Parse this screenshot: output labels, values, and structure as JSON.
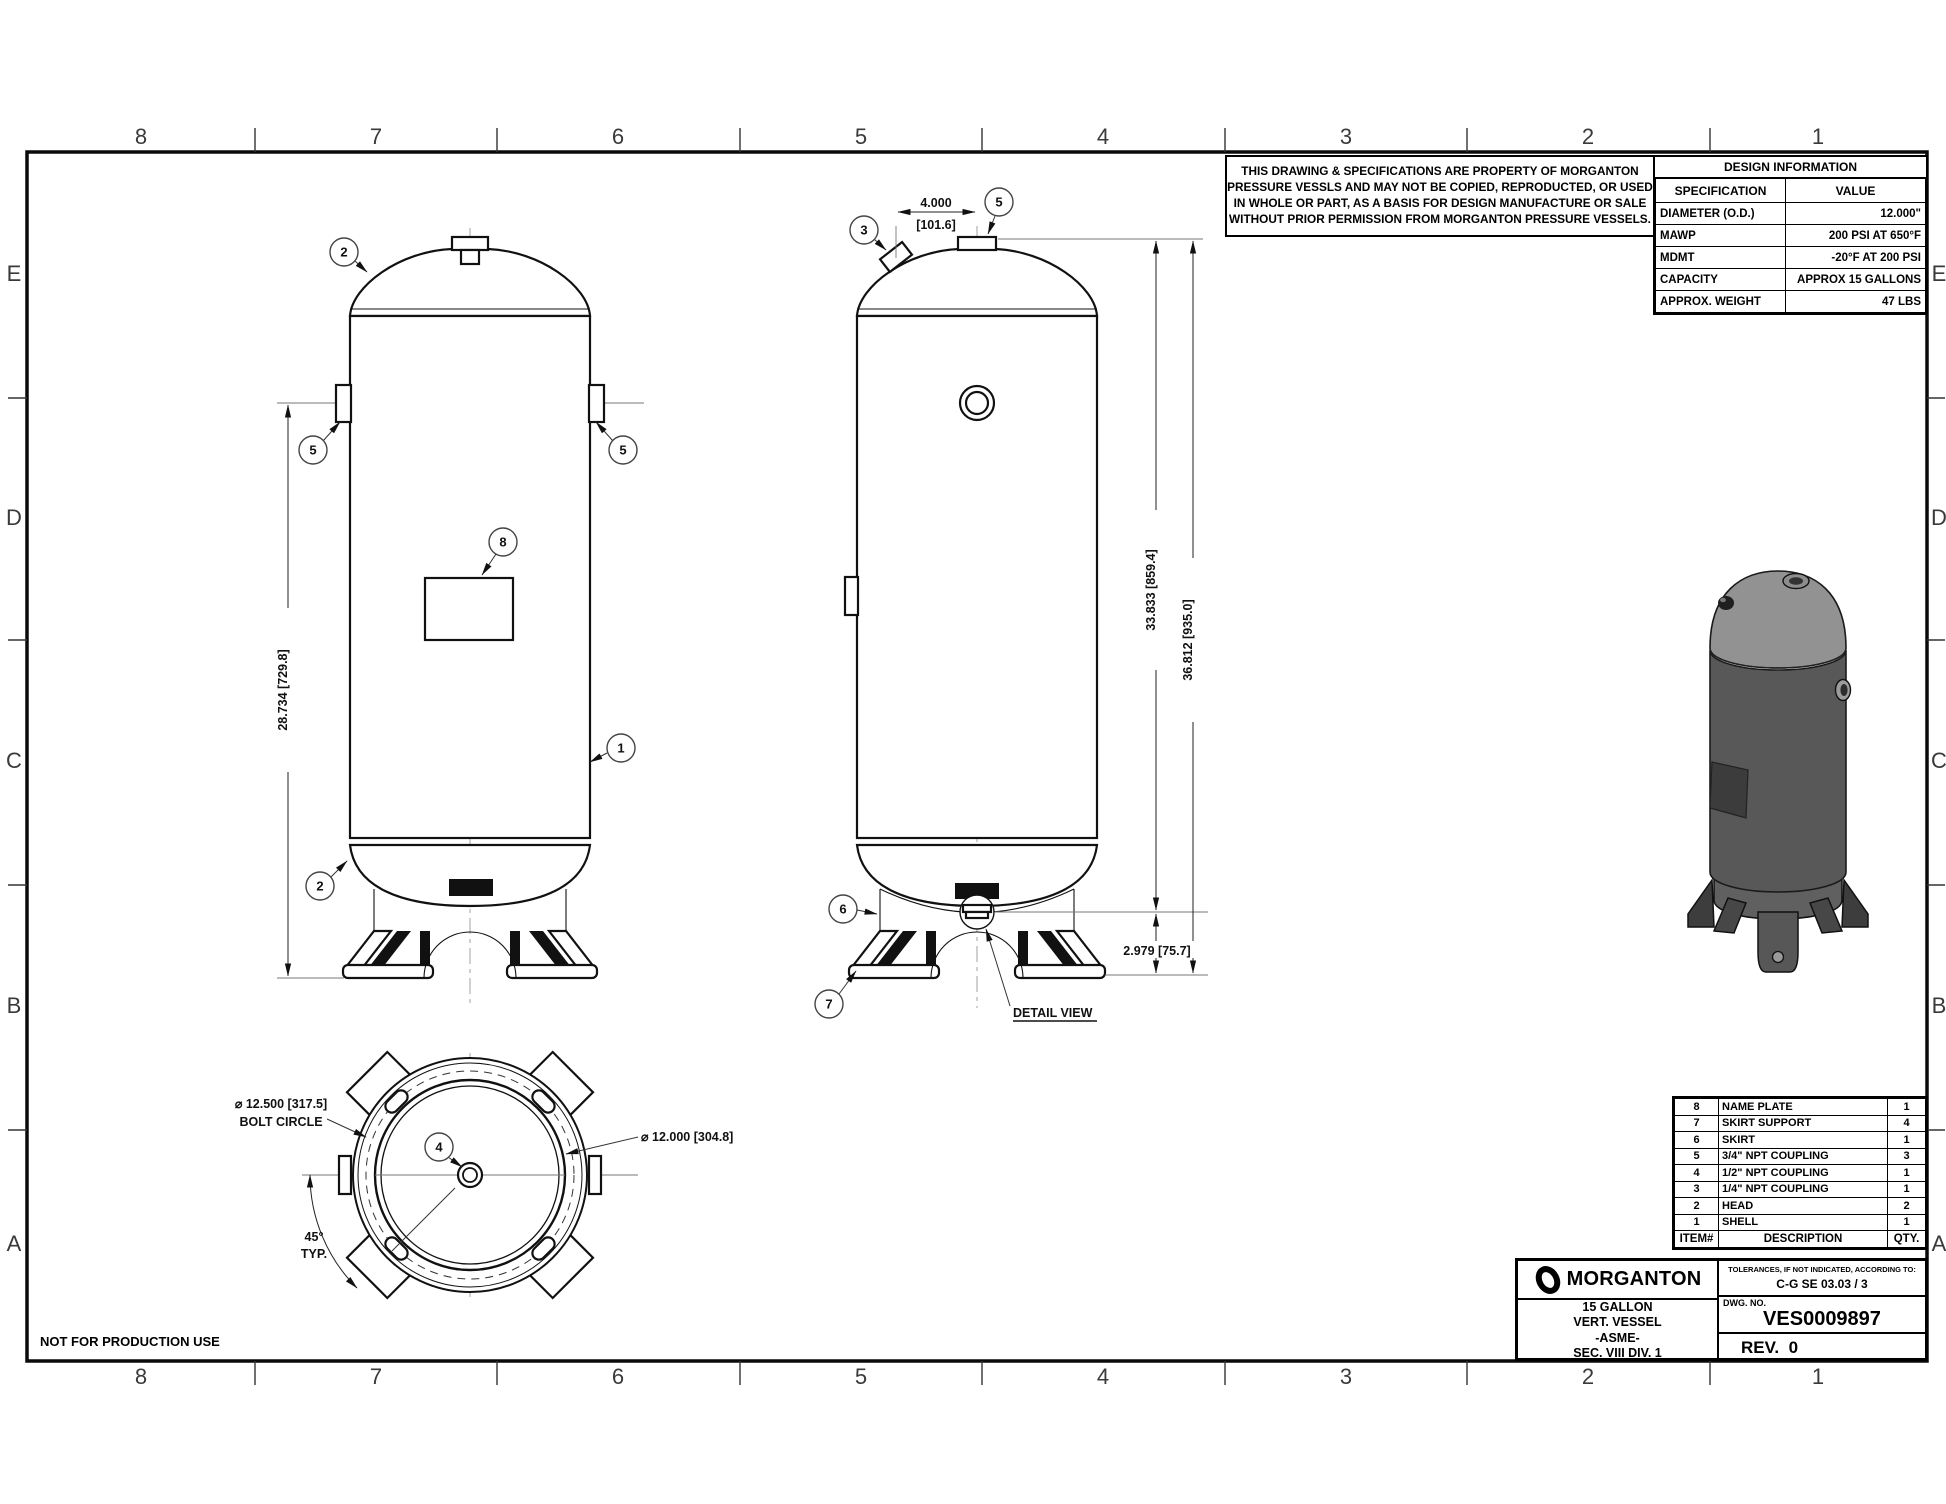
{
  "sheet": {
    "not_for_production": "NOT FOR PRODUCTION USE",
    "grid_cols": [
      "8",
      "7",
      "6",
      "5",
      "4",
      "3",
      "2",
      "1"
    ],
    "grid_rows": [
      "E",
      "D",
      "C",
      "B",
      "A"
    ]
  },
  "copyright": {
    "line1": "THIS DRAWING & SPECIFICATIONS ARE PROPERTY OF MORGANTON",
    "line2": "PRESSURE VESSLS AND MAY NOT BE COPIED, REPRODUCTED,  OR USED",
    "line3": "IN WHOLE OR PART, AS A BASIS FOR DESIGN MANUFACTURE OR SALE",
    "line4": "WITHOUT PRIOR PERMISSION FROM MORGANTON PRESSURE VESSELS."
  },
  "design_info": {
    "title": "DESIGN INFORMATION",
    "col_spec": "SPECIFICATION",
    "col_value": "VALUE",
    "rows": [
      {
        "spec": "DIAMETER (O.D.)",
        "value": "12.000\""
      },
      {
        "spec": "MAWP",
        "value": "200 PSI AT 650°F"
      },
      {
        "spec": "MDMT",
        "value": "-20°F AT 200 PSI"
      },
      {
        "spec": "CAPACITY",
        "value": "APPROX 15 GALLONS"
      },
      {
        "spec": "APPROX. WEIGHT",
        "value": "47 LBS"
      }
    ]
  },
  "parts_list": {
    "header": {
      "item": "ITEM#",
      "desc": "DESCRIPTION",
      "qty": "QTY."
    },
    "rows": [
      {
        "item": "8",
        "desc": "NAME PLATE",
        "qty": "1"
      },
      {
        "item": "7",
        "desc": "SKIRT SUPPORT",
        "qty": "4"
      },
      {
        "item": "6",
        "desc": "SKIRT",
        "qty": "1"
      },
      {
        "item": "5",
        "desc": "3/4\" NPT COUPLING",
        "qty": "3"
      },
      {
        "item": "4",
        "desc": "1/2\" NPT COUPLING",
        "qty": "1"
      },
      {
        "item": "3",
        "desc": "1/4\" NPT COUPLING",
        "qty": "1"
      },
      {
        "item": "2",
        "desc": "HEAD",
        "qty": "2"
      },
      {
        "item": "1",
        "desc": "SHELL",
        "qty": "1"
      }
    ]
  },
  "title_block": {
    "brand": "MORGANTON",
    "product_line1": "15 GALLON",
    "product_line2": "VERT. VESSEL",
    "product_line3": "-ASME-",
    "product_line4": "SEC. VIII DIV. 1",
    "tolerances_label": "TOLERANCES, IF NOT INDICATED, ACCORDING TO:",
    "tolerances_value": "C-G SE 03.03 / 3",
    "dwg_label": "DWG. NO.",
    "dwg_no": "VES0009897",
    "rev": "REV.  0"
  },
  "dimensions": {
    "front_height": "28.734 [729.8]",
    "top_offset_in": "4.000",
    "top_offset_mm": "[101.6]",
    "overall_1": "33.833 [859.4]",
    "overall_2": "36.812 [935.0]",
    "skirt_height": "2.979 [75.7]",
    "detail_view": "DETAIL VIEW",
    "bolt_circle_dia": "⌀ 12.500 [317.5]",
    "bolt_circle_label": "BOLT CIRCLE",
    "outer_dia": "⌀ 12.000 [304.8]",
    "angle": "45°",
    "angle_typ": "TYP."
  },
  "balloons": {
    "n1": "1",
    "n2": "2",
    "n3": "3",
    "n4": "4",
    "n5": "5",
    "n6": "6",
    "n7": "7",
    "n8": "8"
  }
}
